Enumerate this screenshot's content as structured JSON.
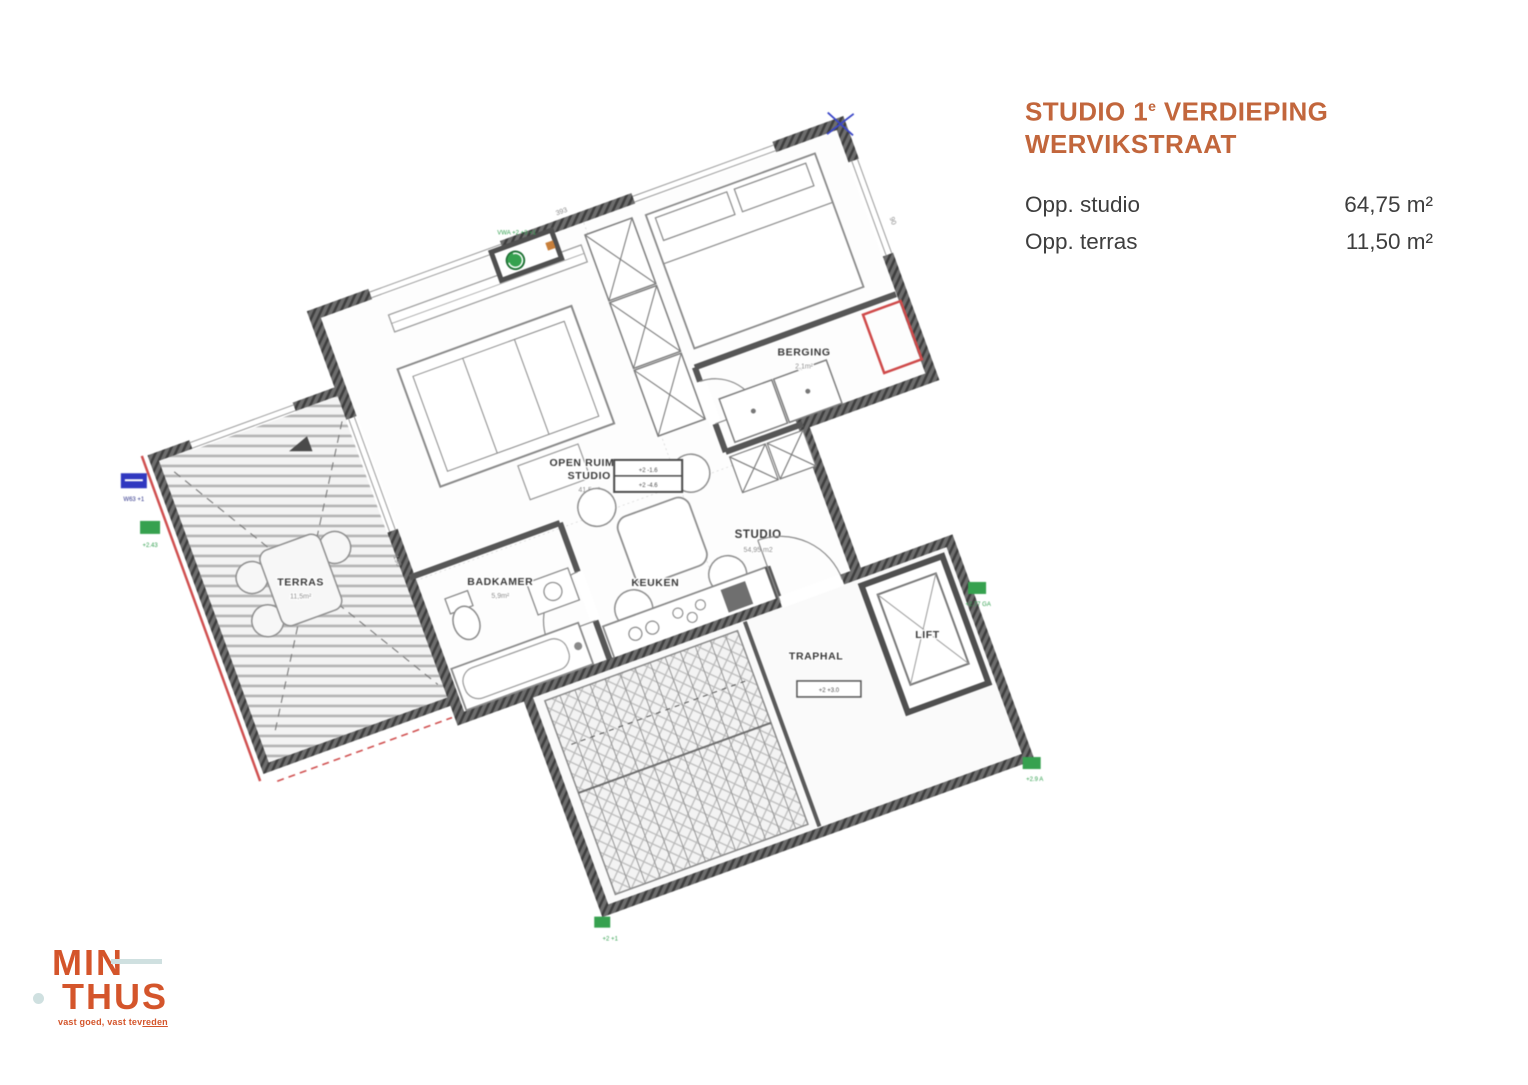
{
  "panel": {
    "title_part1": "STUDIO 1",
    "title_sup": "e",
    "title_part2": " VERDIEPING",
    "title_line2": "WERVIKSTRAAT",
    "rows": [
      {
        "label": "Opp. studio",
        "value": "64,75 m²"
      },
      {
        "label": "Opp. terras",
        "value": "11,50 m²"
      }
    ]
  },
  "logo": {
    "word1": "MIN",
    "word2": "THUS",
    "tagline_pre": "vast goed, vast tev",
    "tagline_underlined": "reden"
  },
  "plan": {
    "rooms": [
      {
        "label": "TERRAS",
        "area": "11,5m²"
      },
      {
        "label": "OPEN RUIMTE",
        "area": "41,5m²"
      },
      {
        "label": "STUDIO",
        "area": ""
      },
      {
        "label": "STUDIO",
        "area": "54,95 m2"
      },
      {
        "label": "KEUKEN",
        "area": ""
      },
      {
        "label": "BADKAMER",
        "area": "5,9m²"
      },
      {
        "label": "BERGING",
        "area": "2,1m²"
      },
      {
        "label": "TRAPHAL",
        "area": ""
      },
      {
        "label": "LIFT",
        "area": ""
      }
    ],
    "annotations": {
      "center_box_row1": "+2  -1.6",
      "center_box_row2": "+2  -4.6",
      "traphal_box": "+2  +3.0",
      "marker_blue_west": "W63 +1",
      "marker_green_west": "+2.43",
      "marker_green_niche": "VWA +2 +3 +1",
      "marker_green_east": "+2.77 GA",
      "marker_green_southeast": "+2.9 A",
      "marker_green_south": "+2 +1",
      "dim_north": "393",
      "dim_east": "90",
      "dim_west": "190"
    }
  },
  "colors": {
    "title_orange": "#c2663c",
    "logo_orange": "#d4552b",
    "logo_accent": "#cfe0e0",
    "body_text": "#3e3e3e",
    "plan_wall": "#4f4f4f",
    "plan_red": "#d05050",
    "plan_green": "#36a14f",
    "plan_blue": "#3038c0"
  }
}
